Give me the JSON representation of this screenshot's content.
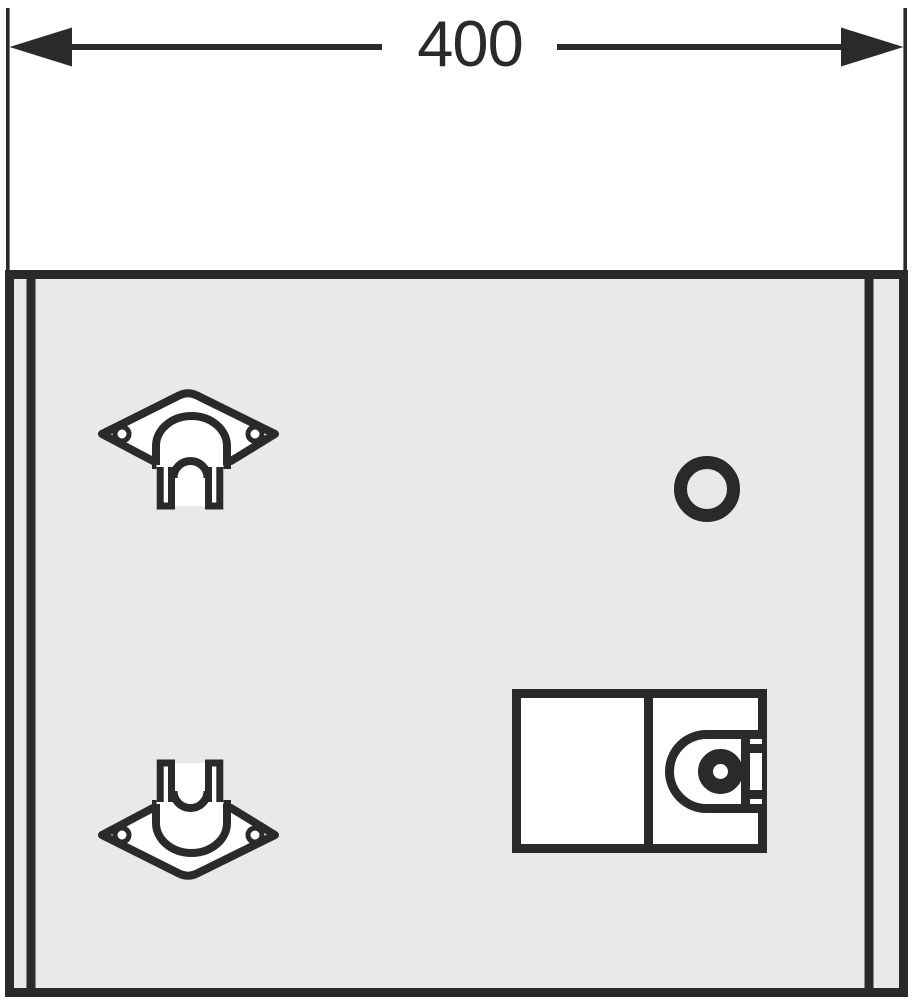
{
  "drawing": {
    "type": "technical installation drawing, front view",
    "dimension": {
      "value": "400",
      "orientation": "horizontal",
      "position": "top"
    },
    "colors": {
      "line": "#2a2a2a",
      "panel_fill": "#e9e9e9",
      "shape_fill": "#ffffff",
      "background": "#ffffff"
    },
    "components": {
      "panel": "front-panel",
      "bracket_top": "mounting-bracket-top-left",
      "bracket_bottom": "mounting-bracket-bottom-left",
      "hole": "round-opening-upper-right",
      "lock_box": "lock-box-lower-right",
      "lock_cylinder": "lock-cylinder"
    }
  }
}
